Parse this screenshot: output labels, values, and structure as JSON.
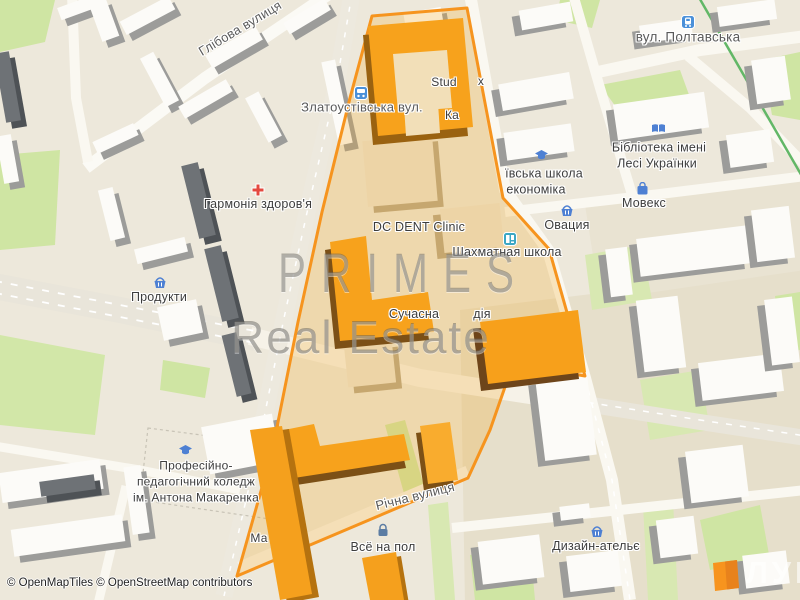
{
  "watermark": {
    "line1": "PRIMES",
    "line2": "Real Estate"
  },
  "attribution": "© OpenMapTiles © OpenStreetMap contributors",
  "logo": {
    "text": "ЛУН"
  },
  "colors": {
    "highlight_border": "#F6941E",
    "highlight_fill": "rgba(245,166,35,0.25)",
    "building_orange": "#F7A21C",
    "building_shadow_brown": "#7C5016",
    "poi_blue": "#4E80D3",
    "medical_red": "#E4493F",
    "green_area": "#CFE5A3",
    "tram_line_green": "#62B767",
    "road_white": "#FAF8F1",
    "base_beige": "#EDE8DB"
  },
  "map": {
    "streets": {
      "glibova": "Глібова вулиця",
      "zlatoustivska": "Златоустівська вул.",
      "poltavska": "вул. Полтавська",
      "richna": "Річна вулиця"
    },
    "pois": {
      "harmonia": {
        "label": "Гармонія здоров'я",
        "icon": "medical-cross-icon"
      },
      "produkty": {
        "label": "Продукти",
        "icon": "shopping-basket-icon"
      },
      "dc_dent": {
        "label": "DC DENT Clinic"
      },
      "chess_school": {
        "label": "Шахматная школа",
        "icon": "chess-school-icon"
      },
      "econ_school": {
        "line1": "ївська школа",
        "line2": "економіка",
        "icon": "graduation-cap-icon"
      },
      "library": {
        "line1": "Бібліотека імені",
        "line2": "Лесі Українки",
        "icon": "open-book-icon"
      },
      "ovatsia": {
        "label": "Овация",
        "icon": "shopping-basket-icon"
      },
      "movex": {
        "label": "Мовекс",
        "icon": "shopping-bag-icon"
      },
      "suchasna": {
        "part1": "Сучасна",
        "part2": "дія"
      },
      "stud": {
        "part1": "Stud",
        "part2": "x"
      },
      "kashtan": {
        "label": "Ка"
      },
      "college": {
        "line1": "Професійно-",
        "line2": "педагогічний коледж",
        "line3": "ім. Антона Макаренка",
        "icon": "graduation-cap-icon"
      },
      "ma": {
        "label": "Ма"
      },
      "vse_na_pol": {
        "label": "Всё на пол",
        "icon": "padlock-icon"
      },
      "design_atelier": {
        "label": "Дизайн-ательє",
        "icon": "shopping-basket-icon"
      }
    },
    "transit": {
      "bus_stop": "bus-stop-icon",
      "tram_stop": "tram-stop-icon"
    }
  }
}
